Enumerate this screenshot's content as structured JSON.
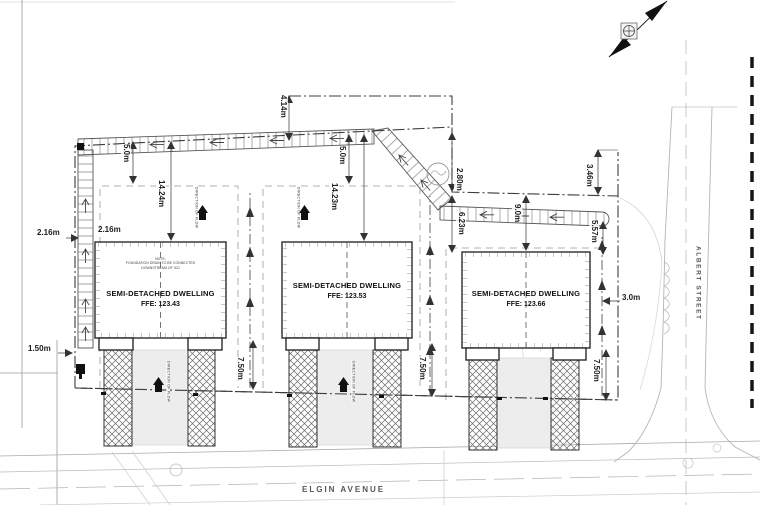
{
  "page": {
    "buildings": [
      {
        "title": "SEMI-DETACHED DWELLING",
        "ffe": "FFE: 123.43",
        "note_line1": "NOTE:",
        "note_line2": "FOUNDATION DRAIN TO BE CONNECTED",
        "note_line3": "DOWNSTREAM OF ICD"
      },
      {
        "title": "SEMI-DETACHED DWELLING",
        "ffe": "FFE: 123.53"
      },
      {
        "title": "SEMI-DETACHED DWELLING",
        "ffe": "FFE: 123.66"
      }
    ],
    "streets": {
      "elgin": "ELGIN AVENUE",
      "albert": "ALBERT STREET"
    },
    "dimensions": {
      "d414": "4.14m",
      "d50": "5.0m",
      "d1424": "14.24m",
      "d1423": "14.23m",
      "d280": "2.80m",
      "d623": "6.23m",
      "d90": "9.0m",
      "d346": "3.46m",
      "d557": "5.57m",
      "d216": "2.16m",
      "d150": "1.50m",
      "d30": "3.0m",
      "d750": "7.50m"
    },
    "labels": {
      "direction_of_flow": "DIRECTION OF FLOW"
    }
  }
}
